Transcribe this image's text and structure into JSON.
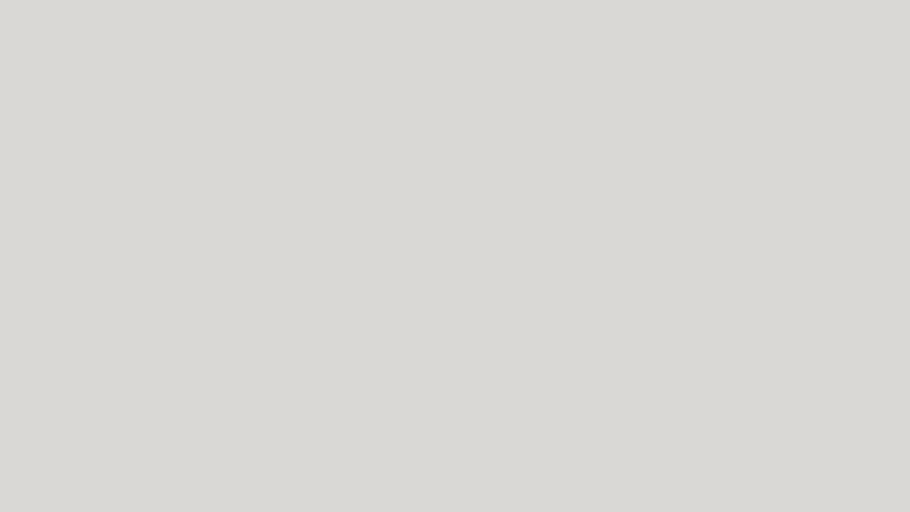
{
  "view_label": "Front",
  "canvas": {
    "w": 910,
    "h": 512,
    "bg": "#d9d8d5"
  },
  "colors": {
    "background": "#d9d8d5",
    "plate_white": "#fcfcfa",
    "indicator_green": "#76b42c",
    "indicator_red": "#c21a0e",
    "strip_yellow": "#f2f0c6",
    "strip_switch_red": "#cf1608",
    "intercom_gray_blue": "#b3bcc6",
    "cable_black": "#1a1a18",
    "jack_blue": "#5b79a8",
    "tan_plate": "#d9d0c3"
  },
  "items": [
    {
      "name": "outlet-au-double-a",
      "kind": "plate",
      "x": 106,
      "y": -2,
      "w": 84,
      "h": 48,
      "rot": -2,
      "dir": "row",
      "pad": 6,
      "modules": [
        "au",
        "au"
      ]
    },
    {
      "name": "outlet-universal-3gang",
      "kind": "plate",
      "x": 196,
      "y": 2,
      "w": 90,
      "h": 50,
      "dir": "row",
      "pad": 7,
      "modules": [
        "blank",
        "blank",
        "universal"
      ]
    },
    {
      "name": "outlet-universal-dot",
      "kind": "plate",
      "x": 292,
      "y": 2,
      "w": 102,
      "h": 50,
      "dir": "row",
      "pad": 9,
      "padx": 17,
      "modules": [
        "universal",
        "dot"
      ]
    },
    {
      "name": "outlet-universal-multi",
      "kind": "plate",
      "x": 402,
      "y": 2,
      "w": 136,
      "h": 50,
      "dir": "row",
      "pad": 8,
      "modules": [
        "blank",
        "blank",
        "blank",
        "circ-sm",
        "universal"
      ]
    },
    {
      "name": "gray-switch-a",
      "kind": "gray",
      "x": 552,
      "y": 0,
      "w": 34,
      "h": 30,
      "glyph": "sw"
    },
    {
      "name": "gray-dimmer-knob",
      "kind": "gray",
      "x": 597,
      "y": 0,
      "w": 43,
      "h": 32,
      "glyph": "knob"
    },
    {
      "name": "gray-switch-b",
      "kind": "gray",
      "x": 551,
      "y": 34,
      "w": 35,
      "h": 36,
      "glyph": "sw"
    },
    {
      "name": "gray-socket-schuko",
      "kind": "gray",
      "x": 597,
      "y": 37,
      "w": 43,
      "h": 33,
      "glyph": "schuko"
    },
    {
      "name": "switch-3gang-green",
      "kind": "plate",
      "x": 242,
      "y": 68,
      "w": 55,
      "h": 54,
      "dir": "row",
      "pad": 4,
      "modules": [
        "swg",
        "swg",
        "swg"
      ]
    },
    {
      "name": "outlet-cn5-with-switch",
      "kind": "plate",
      "x": 303,
      "y": 66,
      "w": 57,
      "h": 56,
      "dir": "row",
      "pad": 4,
      "modules": [
        "cn5",
        "swg"
      ]
    },
    {
      "name": "switch-1gang-green",
      "kind": "plate",
      "x": 365,
      "y": 68,
      "w": 52,
      "h": 54,
      "dir": "row",
      "pad": 4,
      "modules": [
        "swg"
      ]
    },
    {
      "name": "switch-with-outlet-cn5",
      "kind": "plate",
      "x": 424,
      "y": 64,
      "w": 54,
      "h": 58,
      "dir": "row",
      "pad": 4,
      "modules": [
        "swg",
        "cn5"
      ]
    },
    {
      "name": "outlet-cn5-single",
      "kind": "plate",
      "x": 486,
      "y": 66,
      "w": 54,
      "h": 56,
      "dir": "row",
      "pad": 5,
      "modules": [
        "cn5"
      ]
    },
    {
      "name": "outlet-au-double-b",
      "kind": "plate",
      "x": 547,
      "y": 74,
      "w": 81,
      "h": 54,
      "dir": "row",
      "pad": 6,
      "modules": [
        "au",
        "au"
      ]
    },
    {
      "name": "outlet-universal-2gang",
      "kind": "plate",
      "x": 634,
      "y": 76,
      "w": 80,
      "h": 46,
      "dir": "row",
      "pad": 7,
      "modules": [
        "blank",
        "blank",
        "universal"
      ]
    },
    {
      "name": "socket-uk-double-a",
      "kind": "uk",
      "x": 437,
      "y": 139,
      "w": 101,
      "h": 53,
      "style": "white"
    },
    {
      "name": "socket-uk-double-b",
      "kind": "uk",
      "x": 548,
      "y": 139,
      "w": 92,
      "h": 52,
      "style": "white"
    },
    {
      "name": "socket-uk-double-metal",
      "kind": "uk",
      "x": 650,
      "y": 138,
      "w": 97,
      "h": 58,
      "style": "metal"
    },
    {
      "name": "socket-uk-double-c",
      "kind": "uk",
      "x": 440,
      "y": 209,
      "w": 97,
      "h": 54,
      "style": "white"
    },
    {
      "name": "socket-uk-double-d",
      "kind": "uk",
      "x": 551,
      "y": 210,
      "w": 90,
      "h": 52,
      "style": "white"
    },
    {
      "name": "switch-framed-double",
      "kind": "sqframe",
      "x": 295,
      "y": 155,
      "w": 55,
      "h": 53,
      "glyph": "sw2v"
    },
    {
      "name": "frame-empty",
      "kind": "sqframe",
      "x": 363,
      "y": 153,
      "w": 57,
      "h": 53,
      "glyph": "blank"
    },
    {
      "name": "socket-framed-3dot",
      "kind": "sqframe",
      "x": 296,
      "y": 224,
      "w": 54,
      "h": 54,
      "glyph": "fr"
    },
    {
      "name": "socket-framed-3pin",
      "kind": "sqframe",
      "x": 363,
      "y": 222,
      "w": 56,
      "h": 54,
      "glyph": "pin3"
    },
    {
      "name": "power-strip",
      "kind": "strip",
      "x": 108,
      "y": 178,
      "w": 42,
      "h": 204,
      "outlets": 6
    },
    {
      "name": "wallplate-clear-duplex",
      "kind": "clearduplex",
      "x": 190,
      "y": 245,
      "w": 82,
      "h": 53
    },
    {
      "name": "outlet-us-quad",
      "kind": "usplate",
      "x": 165,
      "y": 312,
      "w": 67,
      "h": 68,
      "rows": 2,
      "cols": 2
    },
    {
      "name": "outlet-us-duplex",
      "kind": "usplate",
      "x": 245,
      "y": 312,
      "w": 43,
      "h": 66,
      "rows": 2,
      "cols": 1
    },
    {
      "name": "switch-quad-tall",
      "kind": "plate",
      "x": 349,
      "y": 327,
      "w": 44,
      "h": 79,
      "dir": "col",
      "pad": 4,
      "modules": [
        "sw4"
      ]
    },
    {
      "name": "socket-schuko-over-quad-switch",
      "kind": "plate",
      "x": 400,
      "y": 284,
      "w": 39,
      "h": 80,
      "dir": "col",
      "pad": 3,
      "modules": [
        "schuko",
        "sw4"
      ]
    },
    {
      "name": "plate-two-circles",
      "kind": "plate",
      "x": 398,
      "y": 374,
      "w": 41,
      "h": 79,
      "dir": "col",
      "pad": 3,
      "modules": [
        "circ",
        "circ"
      ]
    },
    {
      "name": "plate-single-circle",
      "kind": "plate",
      "x": 403,
      "y": 456,
      "w": 38,
      "h": 41,
      "dir": "col",
      "pad": 3,
      "modules": [
        "circ"
      ]
    },
    {
      "name": "switch-double-small",
      "kind": "plate",
      "x": 452,
      "y": 283,
      "w": 38,
      "h": 38,
      "dir": "row",
      "pad": 3,
      "modules": [
        "blank",
        "blank"
      ]
    },
    {
      "name": "switch-arrows-over-circle",
      "kind": "plate",
      "x": 449,
      "y": 323,
      "w": 43,
      "h": 82,
      "dir": "col",
      "pad": 3,
      "modules": [
        "updown",
        "circ"
      ]
    },
    {
      "name": "plate-frame-blank",
      "kind": "plate",
      "x": 453,
      "y": 414,
      "w": 42,
      "h": 84,
      "dir": "col",
      "pad": 3,
      "modules": [
        "blank-in",
        "blank"
      ]
    },
    {
      "name": "switch-quad-red-indicators",
      "kind": "plate",
      "x": 507,
      "y": 295,
      "w": 43,
      "h": 82,
      "dir": "col",
      "pad": 3,
      "modules": [
        "sw4red"
      ]
    },
    {
      "name": "plate-blank-wide",
      "kind": "plate",
      "x": 505,
      "y": 380,
      "w": 44,
      "h": 35,
      "dir": "row",
      "pad": 3,
      "modules": [
        "blank"
      ]
    },
    {
      "name": "plate-wire-arc",
      "kind": "plate",
      "x": 505,
      "y": 417,
      "w": 43,
      "h": 80,
      "dir": "col",
      "pad": 3,
      "modules": [
        "arc",
        "blank"
      ]
    },
    {
      "name": "outlet-ethernet-double",
      "kind": "plate",
      "x": 568,
      "y": 317,
      "w": 40,
      "h": 40,
      "dir": "row",
      "pad": 4,
      "modules": [
        "rj45x2"
      ]
    },
    {
      "name": "switch-red-indicator",
      "kind": "plate",
      "x": 568,
      "y": 360,
      "w": 40,
      "h": 38,
      "dir": "row",
      "pad": 4,
      "modules": [
        "redrect"
      ]
    },
    {
      "name": "switch-double-over-circle",
      "kind": "plate",
      "x": 618,
      "y": 272,
      "w": 44,
      "h": 78,
      "dir": "col",
      "pad": 3,
      "modules": [
        "rocker2",
        "circ"
      ]
    },
    {
      "name": "socket-tv-sat",
      "kind": "plate",
      "x": 620,
      "y": 357,
      "w": 42,
      "h": 35,
      "dir": "row",
      "pad": 4,
      "modules": [
        "tv"
      ]
    },
    {
      "name": "plate-blank-over-circle",
      "kind": "plate",
      "x": 665,
      "y": 322,
      "w": 42,
      "h": 78,
      "dir": "col",
      "pad": 3,
      "modules": [
        "blank",
        "circ"
      ]
    },
    {
      "name": "switch-arrows-over-schuko",
      "kind": "plate",
      "x": 710,
      "y": 313,
      "w": 43,
      "h": 85,
      "dir": "col",
      "pad": 3,
      "modules": [
        "updown",
        "schuko"
      ]
    },
    {
      "name": "switch-arrows-quad",
      "kind": "plate",
      "x": 757,
      "y": 318,
      "w": 35,
      "h": 80,
      "dir": "col",
      "pad": 3,
      "modules": [
        "updown4",
        "updown"
      ]
    },
    {
      "name": "outlet-tan-double",
      "kind": "tan",
      "x": 807,
      "y": 318,
      "w": 48,
      "h": 50
    },
    {
      "name": "outlet-cn5-with-switch-edge",
      "kind": "plate",
      "x": 862,
      "y": 315,
      "w": 49,
      "h": 55,
      "dir": "row",
      "pad": 4,
      "modules": [
        "cn5",
        "swg"
      ]
    },
    {
      "name": "switch-toggle-3gang",
      "kind": "toggleplate",
      "x": 110,
      "y": 392,
      "w": 88,
      "h": 65,
      "toggles": 3
    },
    {
      "name": "switch-toggle-1gang",
      "kind": "toggleplate",
      "x": 213,
      "y": 393,
      "w": 42,
      "h": 64,
      "toggles": 1
    },
    {
      "name": "switch-toggle-2gang",
      "kind": "toggleplate",
      "x": 270,
      "y": 393,
      "w": 61,
      "h": 62,
      "toggles": 2
    },
    {
      "name": "outlet-universal-thai",
      "kind": "thai",
      "x": 217,
      "y": 485,
      "w": 76,
      "h": 27
    },
    {
      "name": "socket-schuko-2gang",
      "kind": "plate",
      "x": 557,
      "y": 403,
      "w": 76,
      "h": 45,
      "dir": "row",
      "pad": 4,
      "modules": [
        "schuko",
        "schuko"
      ]
    },
    {
      "name": "socket-schuko-1gang",
      "kind": "plate",
      "x": 637,
      "y": 405,
      "w": 38,
      "h": 43,
      "dir": "row",
      "pad": 4,
      "modules": [
        "schuko"
      ]
    },
    {
      "name": "socket-schuko-tv-3gang",
      "kind": "plate",
      "x": 680,
      "y": 402,
      "w": 117,
      "h": 47,
      "dir": "row",
      "pad": 4,
      "modules": [
        "schuko",
        "schuko",
        "tv"
      ]
    },
    {
      "name": "socket-schuko-3gang",
      "kind": "plate",
      "x": 557,
      "y": 452,
      "w": 116,
      "h": 48,
      "dir": "row",
      "pad": 4,
      "modules": [
        "schuko",
        "schuko",
        "schuko"
      ]
    },
    {
      "name": "socket-schuko-ethernet-3gang",
      "kind": "plate",
      "x": 683,
      "y": 450,
      "w": 115,
      "h": 48,
      "dir": "row",
      "pad": 4,
      "modules": [
        "schuko",
        "schuko",
        "rj45x2"
      ]
    },
    {
      "name": "intercom-panel",
      "kind": "intercom",
      "x": 803,
      "y": 390,
      "w": 57,
      "h": 103,
      "buttons": 6
    },
    {
      "name": "vent-grille-plate",
      "kind": "plate",
      "x": 867,
      "y": 415,
      "w": 38,
      "h": 78,
      "dir": "col",
      "pad": 3,
      "modules": [
        "grille",
        "blank"
      ]
    }
  ],
  "cables": [
    {
      "name": "cable-squiggle-topright",
      "stroke": "#1c1c1a",
      "width": 5,
      "path": "M 894 -6 C 876 18 916 26 904 40 C 894 53 872 56 886 73 C 898 88 930 78 938 58"
    },
    {
      "name": "cable-audio-jack",
      "stroke": "#efefec",
      "width": 1.6,
      "outline": "#9c9c98",
      "outlinewidth": 3,
      "path": "M 146 96 C 160 93 147 80 156 73 C 165 66 178 70 176 79 C 174 88 160 86 163 77 C 166 68 186 62 196 66 C 206 70 198 80 190 76 C 182 72 192 58 204 54 C 211 52 214 57 219 53"
    },
    {
      "name": "cable-usb-black",
      "stroke": "#191917",
      "width": 6,
      "path": "M 252 135 C 232 130 220 128 208 121 C 182 108 138 101 121 123 C 105 145 116 170 144 174 C 172 178 206 164 216 142 C 225 122 201 110 183 118 C 162 127 170 156 189 168 C 204 177 226 186 246 192"
    },
    {
      "name": "cable-usb-gray",
      "stroke": "#bdbdb9",
      "width": 2.5,
      "path": "M 192 214 C 225 212 262 209 298 206"
    },
    {
      "name": "cable-usb-vertical",
      "stroke": "#222220",
      "width": 3,
      "path": "M 168 252 C 163 263 175 269 167 283"
    },
    {
      "name": "cable-bottom-left",
      "stroke": "#1a1a18",
      "width": 8,
      "path": "M 160 488 C 134 497 112 504 86 516"
    }
  ],
  "caps": [
    {
      "name": "usb-a-connector-black",
      "type": "usb-r",
      "x": 250,
      "y": 129,
      "w": 38,
      "h": 15
    },
    {
      "name": "barrel-connector",
      "type": "barrel",
      "x": 244,
      "y": 188,
      "w": 24,
      "h": 9,
      "rot": 18
    },
    {
      "name": "usb-a-connector-gray",
      "type": "usb-l",
      "x": 164,
      "y": 206,
      "w": 34,
      "h": 16
    },
    {
      "name": "usb-a-connector-vertical",
      "type": "usb-v",
      "x": 159,
      "y": 224,
      "w": 18,
      "h": 28
    },
    {
      "name": "audio-jack-left",
      "type": "jack-l",
      "x": 104,
      "y": 91,
      "w": 38,
      "h": 10
    },
    {
      "name": "audio-jack-right",
      "type": "jack-r",
      "x": 219,
      "y": 47,
      "w": 43,
      "h": 10
    },
    {
      "name": "ferrite-bead",
      "type": "ferrite",
      "x": 213,
      "y": 206,
      "w": 17,
      "h": 10
    },
    {
      "name": "cable-end-connector",
      "type": "head",
      "x": 146,
      "y": 473,
      "w": 38,
      "h": 24,
      "rot": -18
    }
  ]
}
